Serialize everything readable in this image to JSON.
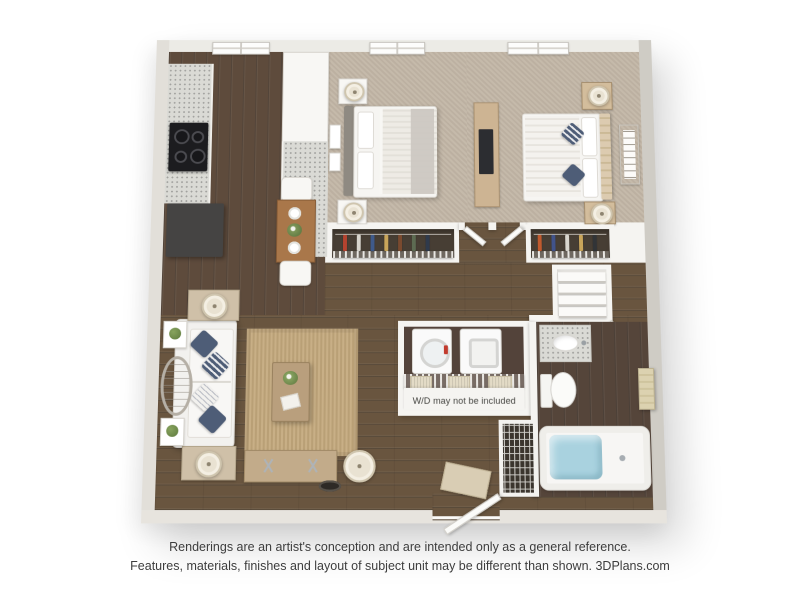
{
  "plan": {
    "wd_note": "W/D may not be included"
  },
  "disclaimer": {
    "line1": "Renderings are an artist's conception and are intended only as a general reference.",
    "line2": "Features, materials, finishes and layout of subject unit may be different than shown. 3DPlans.com"
  },
  "colors": {
    "outerwall": "#d9d6d0",
    "innerwall": "#f5f4f1",
    "wood": "#5e4b3c",
    "woodlight": "#69553f",
    "wooddark": "#53433a",
    "carpet": "#c2b6a6",
    "granite": "#dadad5",
    "rug": "#c3a87c",
    "navy": "#4e5d77",
    "water": "#a9d2df",
    "cream": "#e9e2d2",
    "appliance": "#454443",
    "closet": "#473e34",
    "text": "#3d3d3d"
  }
}
